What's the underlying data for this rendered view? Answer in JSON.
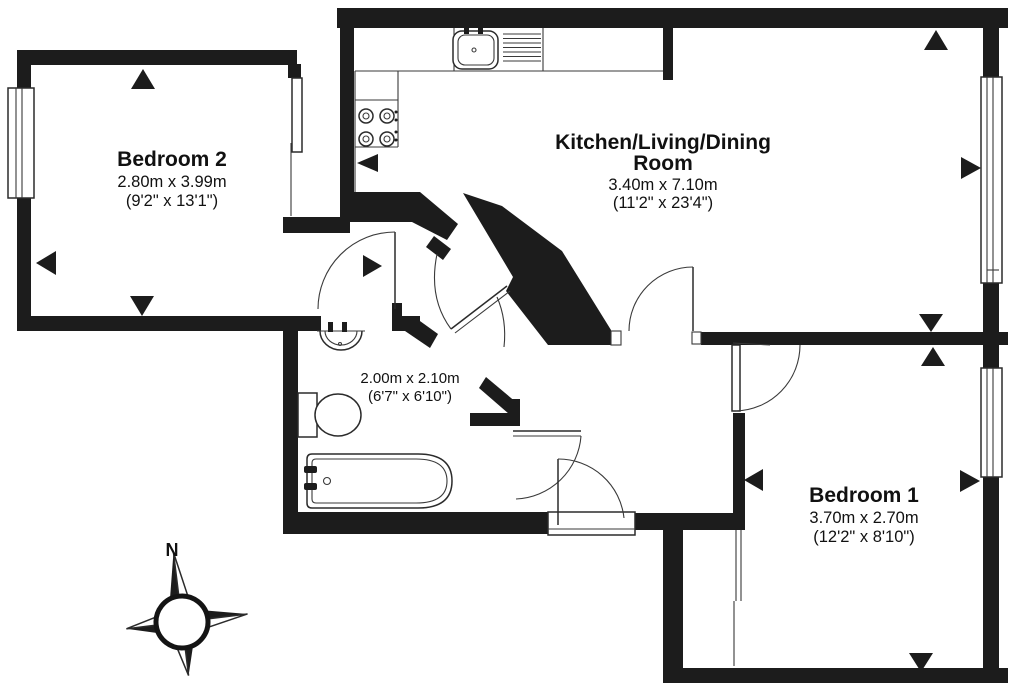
{
  "rooms": {
    "bedroom2": {
      "name": "Bedroom 2",
      "metric": "2.80m x 3.99m",
      "imperial": "(9'2\" x 13'1\")"
    },
    "kitchen_living_dining": {
      "name_line1": "Kitchen/Living/Dining",
      "name_line2": "Room",
      "metric": "3.40m x 7.10m",
      "imperial": "(11'2\" x 23'4\")"
    },
    "bedroom1": {
      "name": "Bedroom 1",
      "metric": "3.70m x 2.70m",
      "imperial": "(12'2\" x 8'10\")"
    },
    "bathroom": {
      "metric": "2.00m x 2.10m",
      "imperial": "(6'7\" x 6'10\")"
    }
  },
  "compass": {
    "north_label": "N"
  },
  "colors": {
    "wall": "#1c1c1c",
    "line": "#2b2b2b",
    "background": "#ffffff"
  },
  "fixtures": [
    "kitchen-sink",
    "drainer",
    "hob",
    "bathtub",
    "toilet",
    "basin"
  ]
}
